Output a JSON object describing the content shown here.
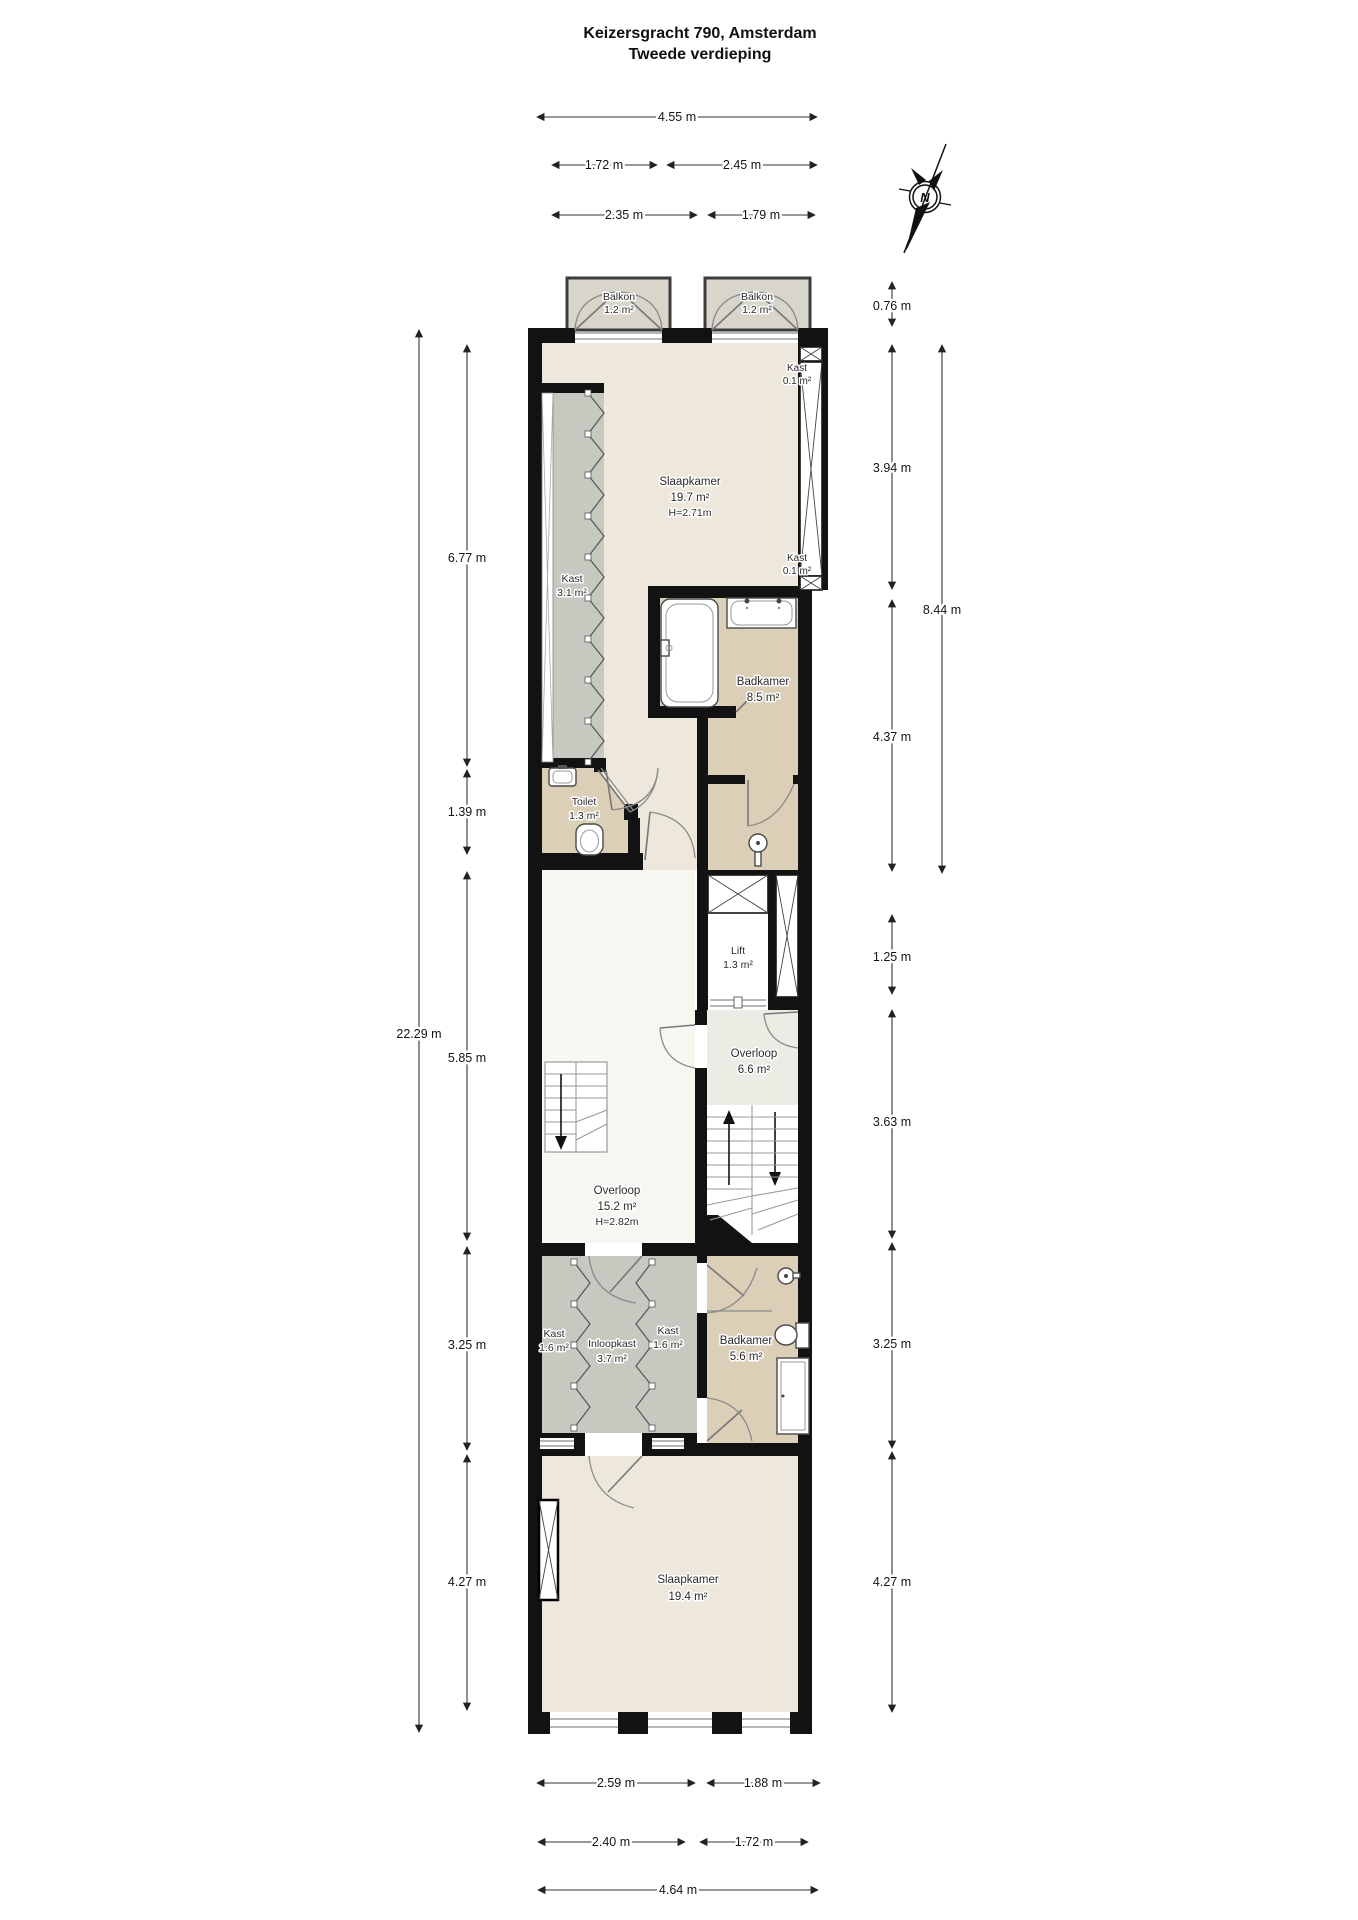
{
  "title": {
    "line1": "Keizersgracht 790, Amsterdam",
    "line2": "Tweede verdieping"
  },
  "compass": {
    "north_label": "N"
  },
  "dimensions": {
    "top": {
      "total": "4.55 m",
      "row2_left": "1.72 m",
      "row2_right": "2.45 m",
      "row3_left": "2.35 m",
      "row3_right": "1.79 m"
    },
    "left": {
      "outer": "22.29 m",
      "seg1": "6.77 m",
      "seg2": "1.39 m",
      "seg3": "5.85 m",
      "seg4": "3.25 m",
      "seg5": "4.27 m"
    },
    "right": {
      "balcony": "0.76 m",
      "seg1": "3.94 m",
      "outer": "8.44 m",
      "seg2": "4.37 m",
      "seg3": "1.25 m",
      "seg4": "3.63 m",
      "seg5": "3.25 m",
      "seg6": "4.27 m"
    },
    "bottom": {
      "row1_left": "2.59 m",
      "row1_right": "1.88 m",
      "row2_left": "2.40 m",
      "row2_right": "1.72 m",
      "total": "4.64 m"
    }
  },
  "rooms": {
    "balkon_links": {
      "name": "Balkon",
      "area": "1.2 m²"
    },
    "balkon_rechts": {
      "name": "Balkon",
      "area": "1.2 m²"
    },
    "slaapkamer_top": {
      "name": "Slaapkamer",
      "area": "19.7 m²",
      "height": "H=2.71m"
    },
    "kast_garderobe": {
      "name": "Kast",
      "area": "3.1 m²"
    },
    "kast_flue_top": {
      "name": "Kast",
      "area": "0.1 m²"
    },
    "kast_flue_onder": {
      "name": "Kast",
      "area": "0.1 m²"
    },
    "badkamer_top": {
      "name": "Badkamer",
      "area": "8.5 m²"
    },
    "toilet": {
      "name": "Toilet",
      "area": "1.3 m²"
    },
    "lift": {
      "name": "Lift",
      "area": "1.3 m²"
    },
    "overloop_klein": {
      "name": "Overloop",
      "area": "6.6 m²"
    },
    "overloop_groot": {
      "name": "Overloop",
      "area": "15.2 m²",
      "height": "H=2.82m"
    },
    "kast_links": {
      "name": "Kast",
      "area": "1.6 m²"
    },
    "inloopkast": {
      "name": "Inloopkast",
      "area": "3.7 m²"
    },
    "kast_rechts": {
      "name": "Kast",
      "area": "1.6 m²"
    },
    "badkamer_onder": {
      "name": "Badkamer",
      "area": "5.6 m²"
    },
    "slaapkamer_onder": {
      "name": "Slaapkamer",
      "area": "19.4 m²"
    }
  },
  "colors": {
    "wall": "#121212",
    "floor_cream": "#EDE8DB",
    "floor_tan": "#DCCFB8",
    "floor_gray": "#C6C9C0",
    "floor_balcony": "#D8D5CB",
    "floor_landing": "#ECECE5",
    "floor_white": "#F7F6F1"
  }
}
